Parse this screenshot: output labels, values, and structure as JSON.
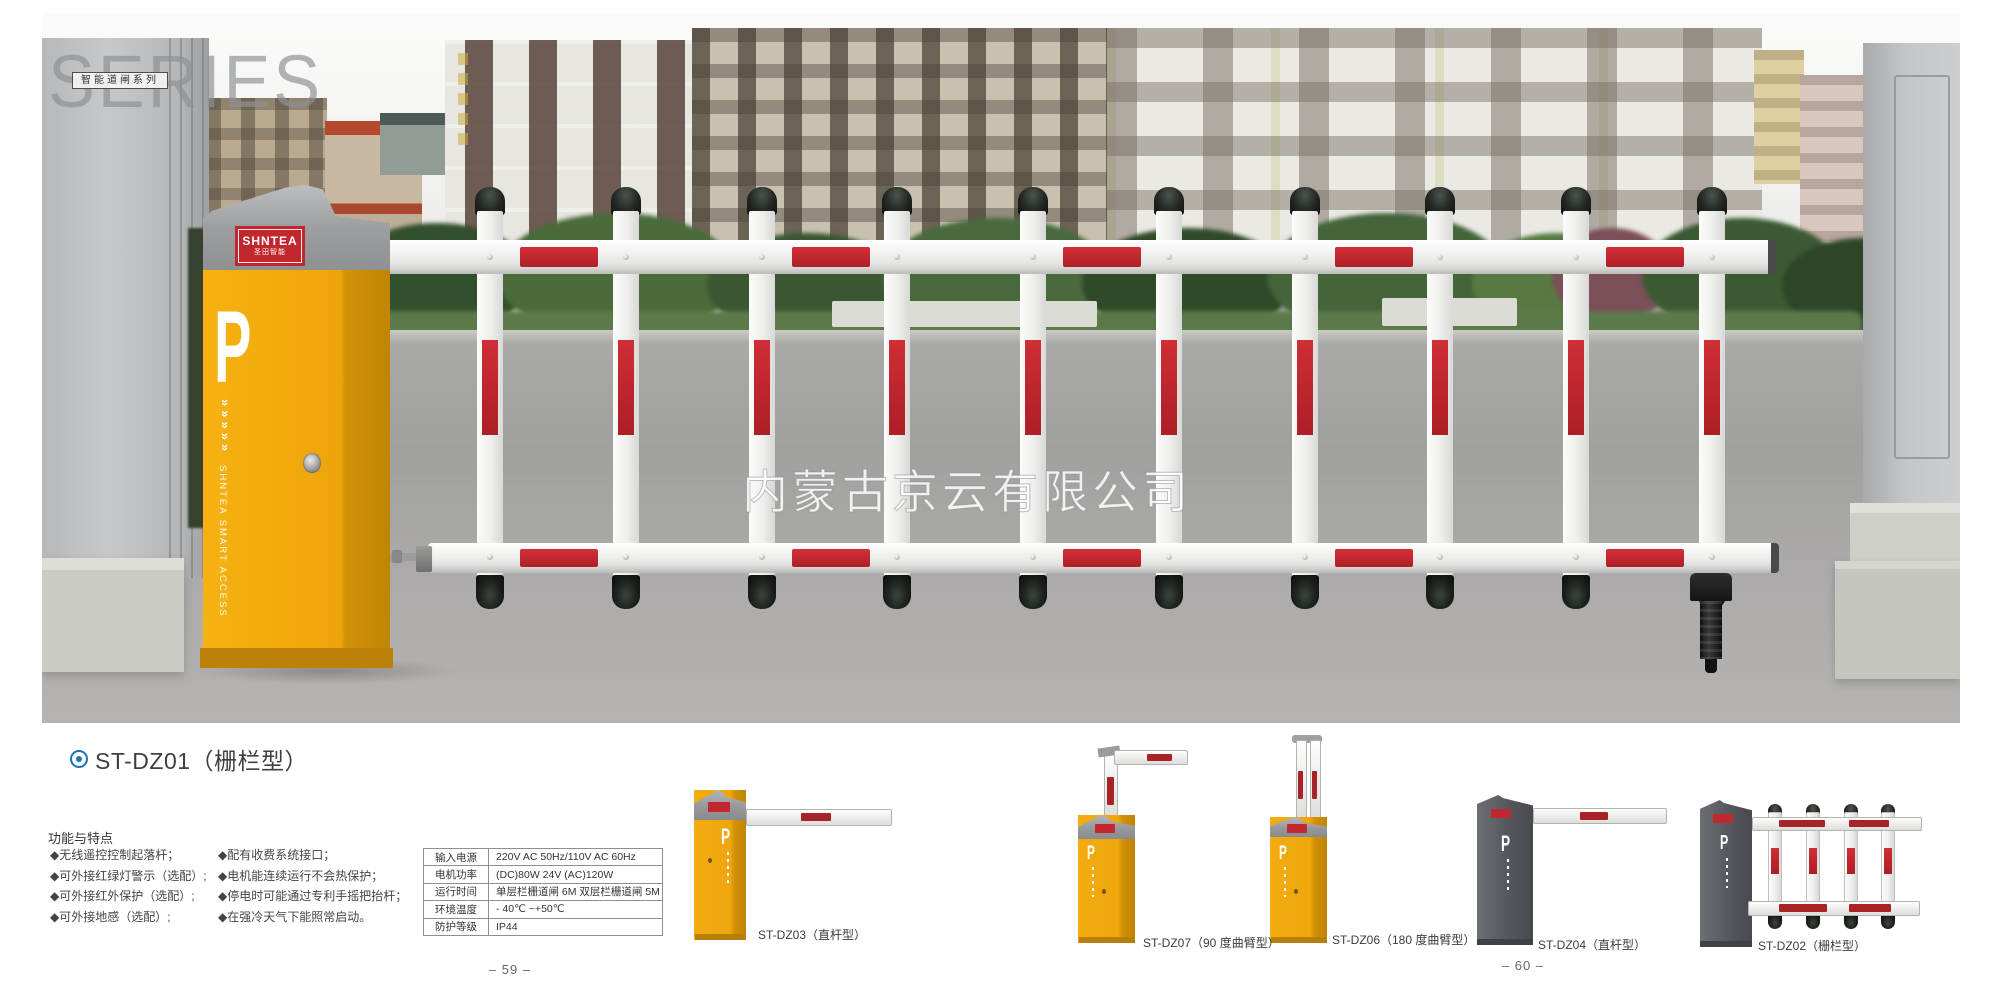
{
  "header": {
    "series": "SERIES",
    "series_tag": "智能道闸系列"
  },
  "photo": {
    "watermark": "内蒙古京云有限公司"
  },
  "machine": {
    "brand": "SHNTEA",
    "brand_cn": "圣田智能",
    "parking_letter": "P",
    "chevrons": "»»»»»",
    "side_text": "SHNTEA SMART ACCESS"
  },
  "product": {
    "bullet_title": "ST-DZ01（栅栏型）"
  },
  "features": {
    "heading": "功能与特点",
    "col1": [
      "◆无线遥控控制起落杆；",
      "◆可外接红绿灯警示（选配）;",
      "◆可外接红外保护（选配）;",
      "◆可外接地感（选配）;"
    ],
    "col2": [
      "◆配有收费系统接口；",
      "◆电机能连续运行不会热保护；",
      "◆停电时可能通过专利手摇把抬杆；",
      "◆在强冷天气下能照常启动。"
    ]
  },
  "specs": {
    "rows": [
      {
        "label": "输入电源",
        "value": "220V AC 50Hz/110V AC 60Hz"
      },
      {
        "label": "电机功率",
        "value": "(DC)80W 24V (AC)120W"
      },
      {
        "label": "运行时间",
        "value": "单层栏栅道闸 6M 双层栏栅道闸 5M"
      },
      {
        "label": "环境温度",
        "value": "- 40℃ ~+50℃"
      },
      {
        "label": "防护等级",
        "value": "IP44"
      }
    ]
  },
  "thumbnails": [
    {
      "label": "ST-DZ03（直杆型）"
    },
    {
      "label": "ST-DZ07（90 度曲臂型）"
    },
    {
      "label": "ST-DZ06（180 度曲臂型）"
    },
    {
      "label": "ST-DZ04（直杆型）"
    },
    {
      "label": "ST-DZ02（栅栏型）"
    }
  ],
  "pages": {
    "left": "– 59 –",
    "right": "– 60 –"
  },
  "colors": {
    "accent_yellow": "#efa70b",
    "accent_red": "#c1272d",
    "fence_red": "#c32430",
    "bullet_blue": "#1a74b8"
  }
}
